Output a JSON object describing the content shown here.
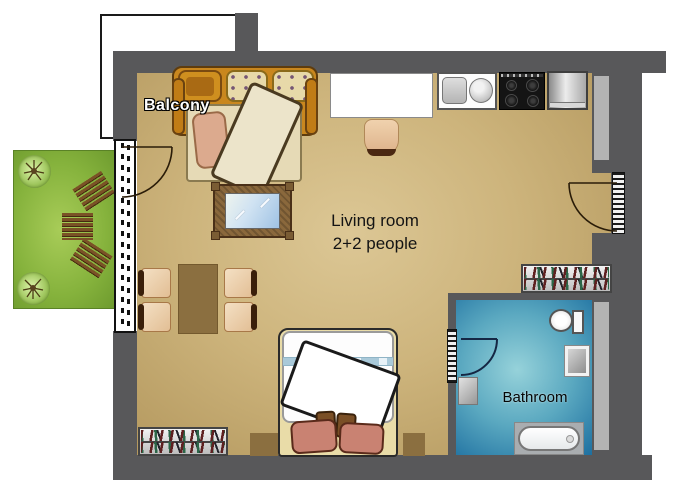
{
  "labels": {
    "balcony": "Balcony",
    "living_room": "Living room",
    "living_room_capacity": "2+2 people",
    "bathroom": "Bathroom"
  },
  "rooms": [
    {
      "name": "Balcony"
    },
    {
      "name": "Living room",
      "capacity": "2+2 people"
    },
    {
      "name": "Bathroom"
    }
  ],
  "furniture": [
    "sofa-bed",
    "blanket",
    "throw-pillow",
    "tv",
    "dining-table",
    "dining-chairs",
    "double-bed",
    "bed-pillows",
    "nightstands",
    "bookshelf-left",
    "bookshelf-right",
    "desk",
    "desk-chair",
    "kitchen-sink",
    "stove",
    "refrigerator",
    "toilet",
    "bathroom-sink",
    "washing-machine",
    "bathtub",
    "garden-trees",
    "garden-benches",
    "garden-table",
    "balcony-door",
    "entrance-door",
    "bathroom-door",
    "window"
  ],
  "colors": {
    "wall": "#58585a",
    "floor_center": "#dcc795",
    "floor_edge": "#b0945a",
    "bathroom_center": "#96d2da",
    "bathroom_edge": "#1d6fa0",
    "garden_green": "#85b23c",
    "sofa_orange": "#c9871e",
    "balcony_fill": "#ffffff"
  }
}
